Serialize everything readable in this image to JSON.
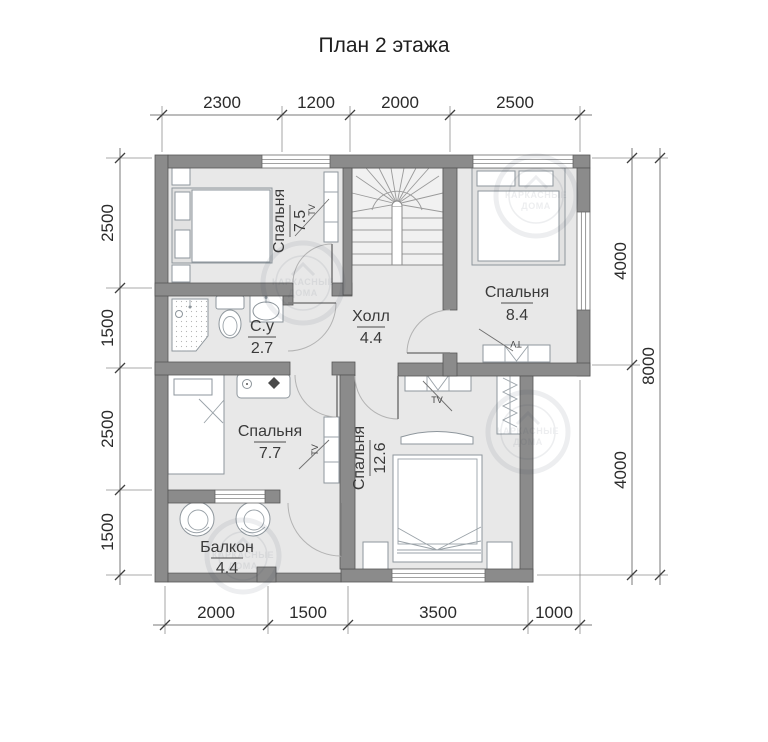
{
  "title": "План 2 этажа",
  "rooms": {
    "bedroom1": {
      "name": "Спальня",
      "area": "7.5"
    },
    "bedroom2": {
      "name": "Спальня",
      "area": "8.4"
    },
    "hall": {
      "name": "Холл",
      "area": "4.4"
    },
    "bathroom": {
      "name": "С.у",
      "area": "2.7"
    },
    "bedroom3": {
      "name": "Спальня",
      "area": "7.7"
    },
    "bedroom4": {
      "name": "Спальня",
      "area": "12.6"
    },
    "balcony": {
      "name": "Балкон",
      "area": "4.4"
    }
  },
  "dimensions": {
    "top": [
      "2300",
      "1200",
      "2000",
      "2500"
    ],
    "bottom": [
      "2000",
      "1500",
      "3500",
      "1000"
    ],
    "left": [
      "2500",
      "1500",
      "2500",
      "1500"
    ],
    "right_inner": [
      "4000",
      "4000"
    ],
    "right_total": "8000"
  },
  "labels": {
    "tv": "TV"
  },
  "watermark": {
    "line1": "КАРКАСНЫЕ",
    "line2": "ДОМА"
  },
  "colors": {
    "wall": "#8b8b8b",
    "floor": "#e8e8e8",
    "stair": "#f1f1f1",
    "bed_platform": "#e2e2e2"
  }
}
